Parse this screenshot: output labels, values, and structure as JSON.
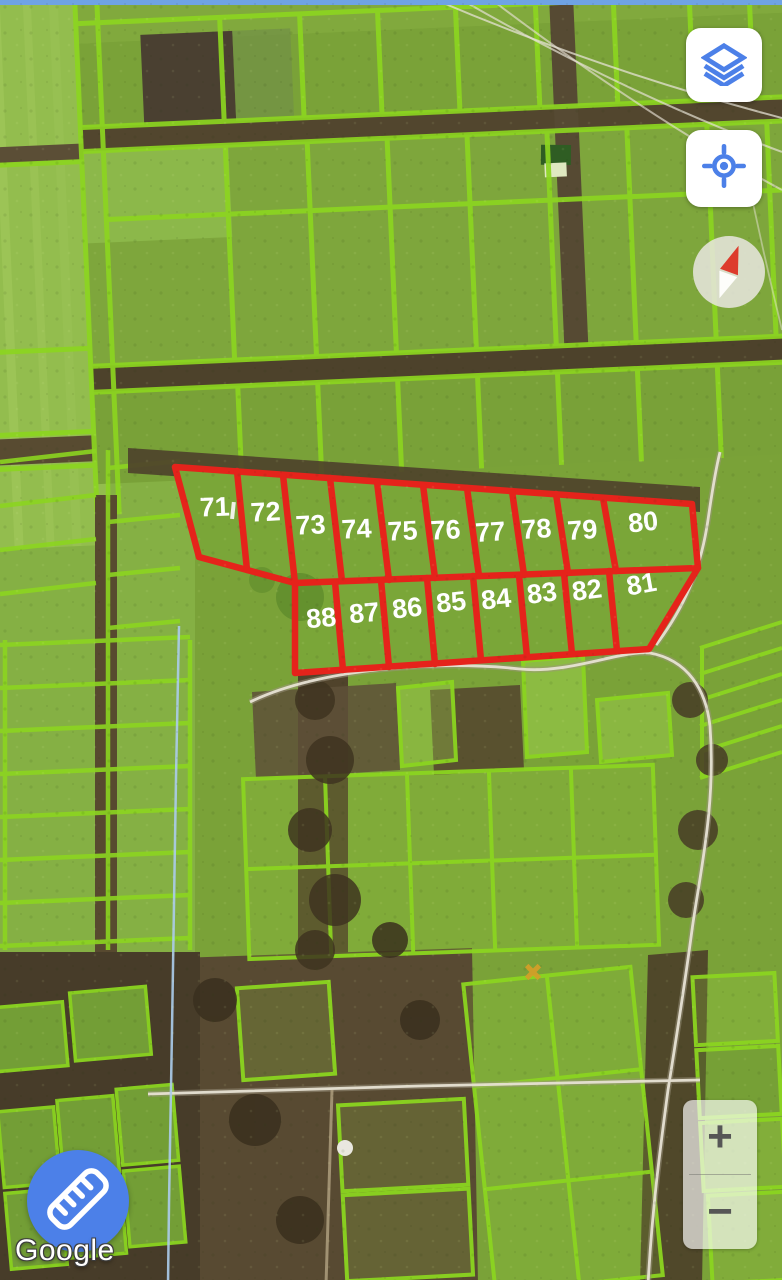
{
  "attribution": {
    "text": "Google"
  },
  "colors": {
    "accent_blue": "#4c80e8",
    "overlay_red": "#e6231c",
    "parcel_line_green": "#8bd51f",
    "label_white": "#ffffff"
  },
  "map": {
    "type": "satellite",
    "overlay_parcel_numbers_visible": true
  },
  "controls": {
    "layers_button": {
      "icon": "layers-icon"
    },
    "locate_button": {
      "icon": "locate-icon"
    },
    "compass": {
      "icon": "compass-needle-icon"
    },
    "zoom": {
      "in_label": "+",
      "out_label": "−"
    },
    "measure_button": {
      "icon": "ruler-icon"
    }
  },
  "parcel_overlay": {
    "labels": [
      {
        "n": "71",
        "x": 215,
        "y": 516,
        "r": -2
      },
      {
        "n": "72",
        "x": 266,
        "y": 521,
        "r": -3
      },
      {
        "n": "73",
        "x": 311,
        "y": 534,
        "r": -3
      },
      {
        "n": "74",
        "x": 357,
        "y": 538,
        "r": -3
      },
      {
        "n": "75",
        "x": 403,
        "y": 540,
        "r": -3
      },
      {
        "n": "76",
        "x": 446,
        "y": 539,
        "r": -3
      },
      {
        "n": "77",
        "x": 491,
        "y": 541,
        "r": -4
      },
      {
        "n": "78",
        "x": 537,
        "y": 538,
        "r": -4
      },
      {
        "n": "79",
        "x": 583,
        "y": 539,
        "r": -4
      },
      {
        "n": "80",
        "x": 644,
        "y": 531,
        "r": -6
      },
      {
        "n": "81",
        "x": 643,
        "y": 593,
        "r": -10
      },
      {
        "n": "82",
        "x": 588,
        "y": 599,
        "r": -7
      },
      {
        "n": "83",
        "x": 543,
        "y": 602,
        "r": -7
      },
      {
        "n": "84",
        "x": 497,
        "y": 608,
        "r": -6
      },
      {
        "n": "85",
        "x": 452,
        "y": 611,
        "r": -6
      },
      {
        "n": "86",
        "x": 408,
        "y": 617,
        "r": -6
      },
      {
        "n": "87",
        "x": 365,
        "y": 622,
        "r": -5
      },
      {
        "n": "88",
        "x": 322,
        "y": 627,
        "r": -5
      }
    ]
  }
}
